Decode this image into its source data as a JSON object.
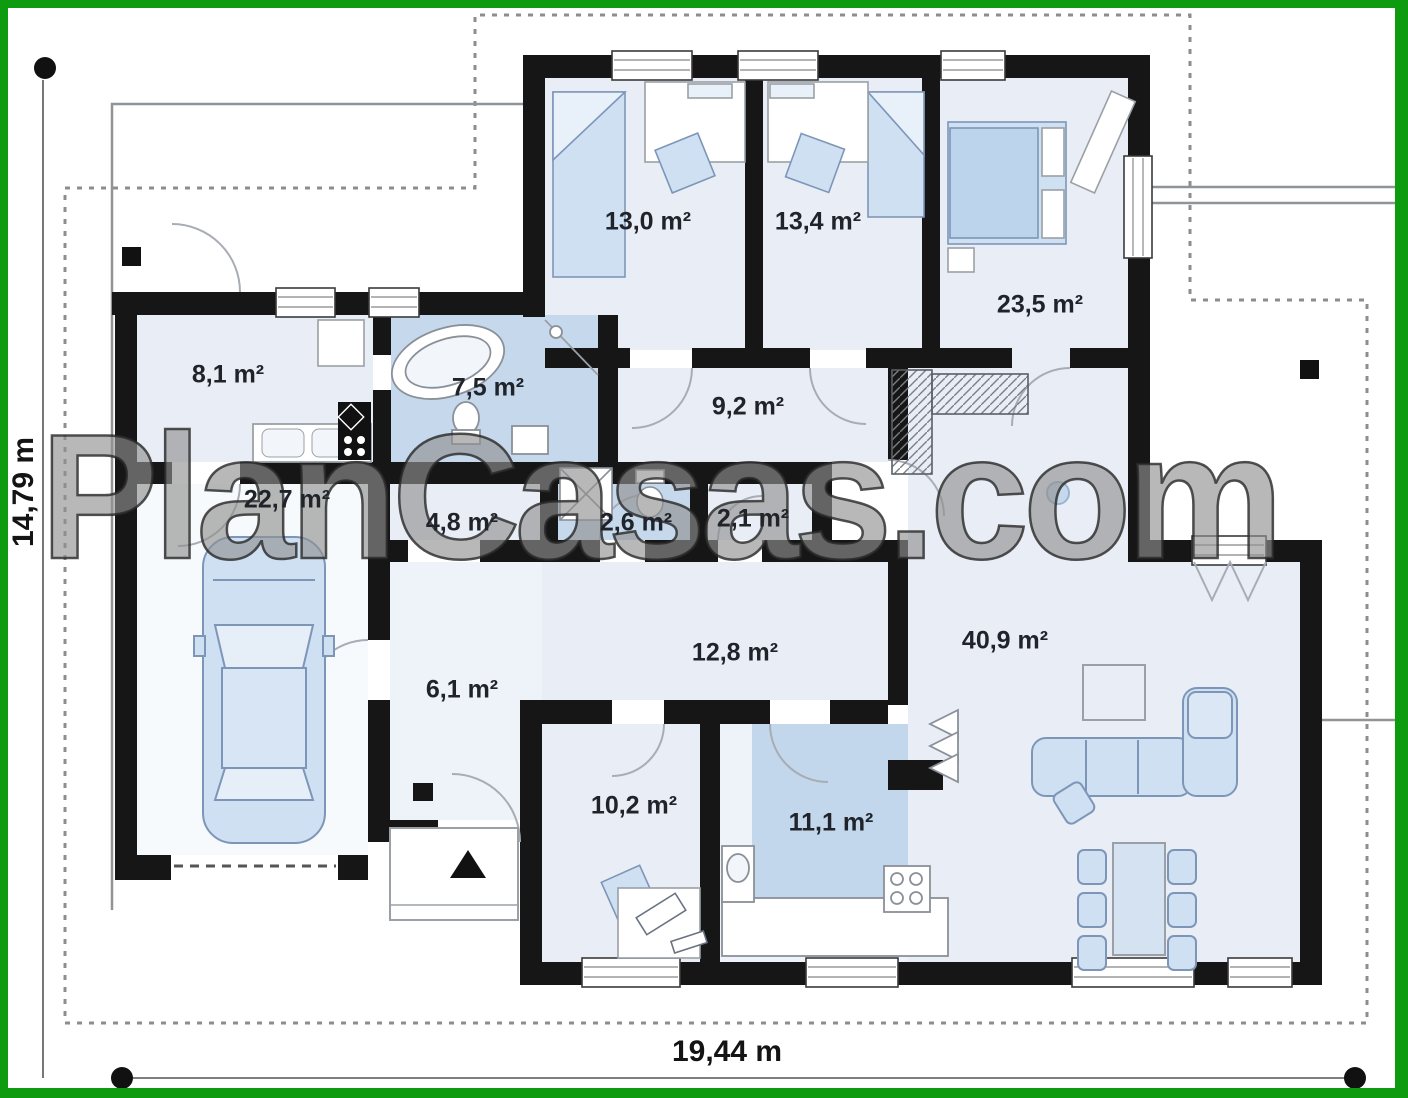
{
  "plan": {
    "watermark": "PlanCasas.com",
    "dimensions": {
      "bottom_total_width": "19,44 m",
      "left_total_height": "14,79 m"
    },
    "rooms": [
      {
        "id": "utility-kitchenette",
        "label": "8,1 m²"
      },
      {
        "id": "bathroom",
        "label": "7,5 m²"
      },
      {
        "id": "bedroom-1",
        "label": "13,0 m²"
      },
      {
        "id": "bedroom-2",
        "label": "13,4 m²"
      },
      {
        "id": "bedroom-3",
        "label": "23,5 m²"
      },
      {
        "id": "hallway",
        "label": "9,2 m²"
      },
      {
        "id": "garage",
        "label": "22,7 m²"
      },
      {
        "id": "storage",
        "label": "4,8 m²"
      },
      {
        "id": "wc",
        "label": "2,6 m²"
      },
      {
        "id": "closet",
        "label": "2,1 m²"
      },
      {
        "id": "entrance-hall",
        "label": "6,1 m²"
      },
      {
        "id": "corridor",
        "label": "12,8 m²"
      },
      {
        "id": "living-room",
        "label": "40,9 m²"
      },
      {
        "id": "office",
        "label": "10,2 m²"
      },
      {
        "id": "kitchen",
        "label": "11,1 m²"
      }
    ]
  }
}
